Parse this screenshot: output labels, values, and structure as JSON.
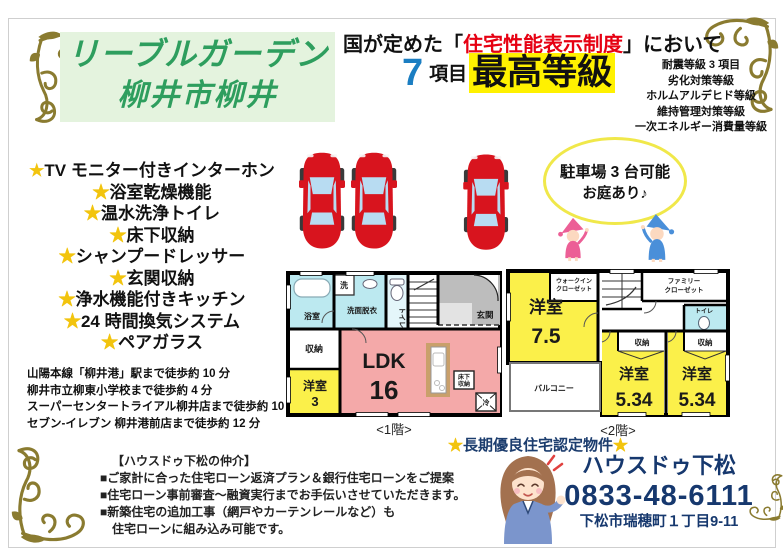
{
  "page": {
    "bg": "#ffffff",
    "frame_color": "#cfcfcf"
  },
  "title": {
    "line1": "リーブルガーデン",
    "line2": "柳井市柳井",
    "color": "#2e9e5e",
    "bg": "#e4f3de"
  },
  "performance": {
    "line1_prefix": "国が定めた",
    "bracket_open": "「",
    "line1_highlight": "住宅性能表示制度",
    "bracket_close": "」",
    "line1_suffix": "において",
    "highlight_color": "#e60012",
    "number": "7",
    "number_color": "#1b7ec2",
    "unit": "項目",
    "grade": "最高等級",
    "grade_bg": "#fff100",
    "grade_items": [
      "耐震等級 3 項目",
      "劣化対策等級",
      "ホルムアルデヒド等級",
      "維持管理対策等級",
      "一次エネルギー消費量等級"
    ]
  },
  "features": {
    "star": "★",
    "star_color": "#f2c40e",
    "items": [
      "TV モニター付きインターホン",
      "浴室乾燥機能",
      "温水洗浄トイレ",
      "床下収納",
      "シャンプードレッサー",
      "玄関収納",
      "浄水機能付きキッチン",
      "24 時間換気システム",
      "ペアガラス"
    ]
  },
  "access": {
    "lines": [
      "山陽本線「柳井港」駅まで徒歩約 10 分",
      "柳井市立柳東小学校まで徒歩約 4 分",
      "スーパーセンタートライアル柳井店まで徒歩約 10 分",
      "セブン-イレブン 柳井港前店まで徒歩約 12 分"
    ]
  },
  "parking_bubble": {
    "line1": "駐車場 3 台可能",
    "line2": "お庭あり♪",
    "border_color": "#f0e84a"
  },
  "floor1": {
    "caption": "<1階>",
    "rooms": {
      "bath": "浴室",
      "washer": "洗",
      "washroom": "洗面脱衣",
      "toilet": "トイレ",
      "entrance": "玄関",
      "storage": "収納",
      "bedroom_name": "洋室",
      "bedroom_size": "3",
      "ldk_name": "LDK",
      "ldk_size": "16",
      "underfloor_line1": "床下",
      "underfloor_line2": "収納",
      "fridge": "冷"
    }
  },
  "floor2": {
    "caption": "<2階>",
    "rooms": {
      "bedroom1_name": "洋室",
      "bedroom1_size": "7.5",
      "wic_line1": "ウォークイン",
      "wic_line2": "クローゼット",
      "fc_line1": "ファミリー",
      "fc_line2": "クローゼット",
      "toilet": "トイレ",
      "storage1": "収納",
      "storage2": "収納",
      "bedroom2_name": "洋室",
      "bedroom2_size": "5.34",
      "bedroom3_name": "洋室",
      "bedroom3_size": "5.34",
      "balcony": "バルコニー"
    }
  },
  "certification": {
    "star_left": "★",
    "text": "長期優良住宅認定物件",
    "star_right": "★",
    "color": "#1c3d6e"
  },
  "agency": {
    "title": "【ハウスドゥ下松の仲介】",
    "bullets": [
      "■ご家計に合った住宅ローン返済プラン＆銀行住宅ローンをご提案",
      "■住宅ローン事前審査～融資実行までお手伝いさせていただきます。",
      "■新築住宅の追加工事（網戸やカーテンレールなど）も",
      "　住宅ローンに組み込み可能です。"
    ]
  },
  "contact": {
    "name": "ハウスドゥ下松",
    "phone": "0833-48-6111",
    "address": "下松市瑞穂町１丁目9-11",
    "color": "#16386e"
  },
  "decor": {
    "flourish_color": "#8a7b30",
    "car_color": "#d8141e",
    "plan_yellow": "#fbf04a",
    "plan_pink": "#f4a9a9",
    "plan_cyan": "#bce9f0"
  }
}
